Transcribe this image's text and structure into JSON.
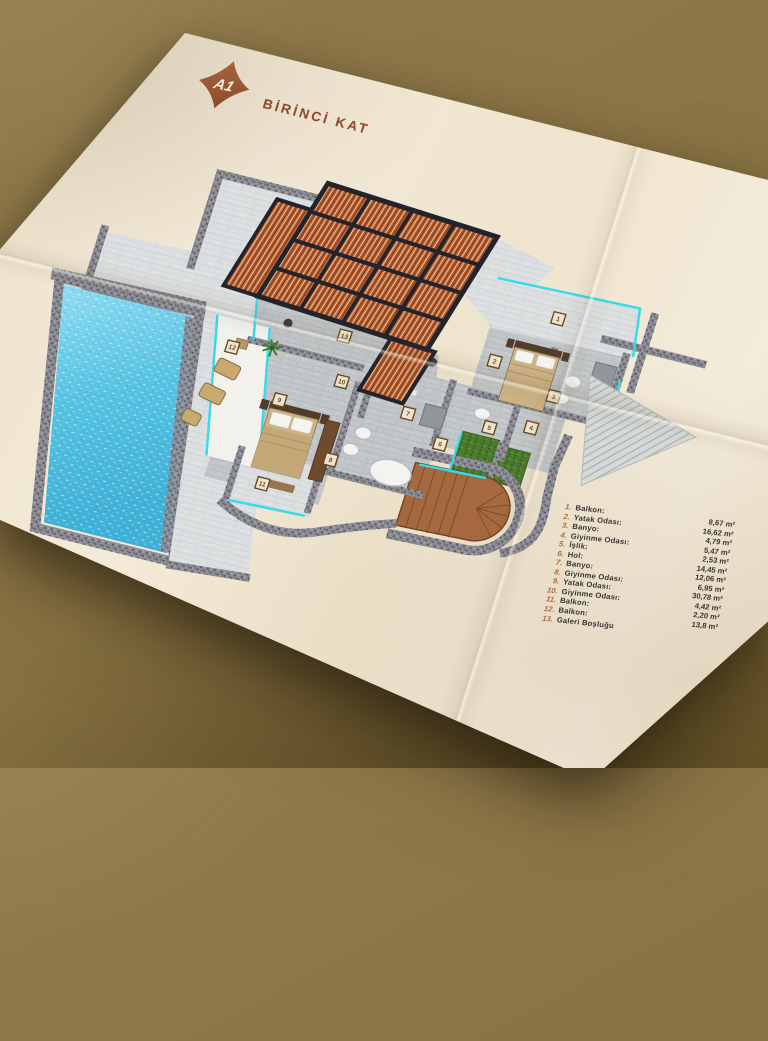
{
  "badge": {
    "label": "A1"
  },
  "header": {
    "title": "BİRİNCİ KAT"
  },
  "legend": {
    "items": [
      {
        "no": "1.",
        "label": "Balkon:",
        "value": "8,67 m²"
      },
      {
        "no": "2.",
        "label": "Yatak Odası:",
        "value": "16,62 m²"
      },
      {
        "no": "3.",
        "label": "Banyo:",
        "value": "4,79 m²"
      },
      {
        "no": "4.",
        "label": "Giyinme Odası:",
        "value": "5,47 m²"
      },
      {
        "no": "5.",
        "label": "İşlik:",
        "value": "2,53 m²"
      },
      {
        "no": "6.",
        "label": "Hol:",
        "value": "14,45 m²"
      },
      {
        "no": "7.",
        "label": "Banyo:",
        "value": "12,06 m²"
      },
      {
        "no": "8.",
        "label": "Giyinme Odası:",
        "value": "6,95 m²"
      },
      {
        "no": "9.",
        "label": "Yatak Odası:",
        "value": "30,78 m²"
      },
      {
        "no": "10.",
        "label": "Giyinme Odası:",
        "value": "4,42 m²"
      },
      {
        "no": "11.",
        "label": "Balkon:",
        "value": "2,20 m²"
      },
      {
        "no": "12.",
        "label": "Balkon:",
        "value": "13,8 m²"
      },
      {
        "no": "13.",
        "label": "Galeri Boşluğu",
        "value": ""
      }
    ]
  },
  "plan": {
    "markers": [
      "1",
      "2",
      "3",
      "4",
      "5",
      "6",
      "7",
      "8",
      "9",
      "10",
      "11",
      "12",
      "13"
    ]
  },
  "colors": {
    "background_brown": "#8c7646",
    "paper_cream": "#f1e7d3",
    "badge_brown": "#a05f3a",
    "title_brown": "#8f4a2b",
    "legend_number": "#b06a3a",
    "legend_text": "#3a3531",
    "glass_cyan": "#35dbe8",
    "pool_blue": "#5ec7e6",
    "pergola_wood": "#b05527",
    "grass_green": "#4a7a2e",
    "wall_gray": "#8b8b94",
    "deck_wood": "#a5683f"
  }
}
